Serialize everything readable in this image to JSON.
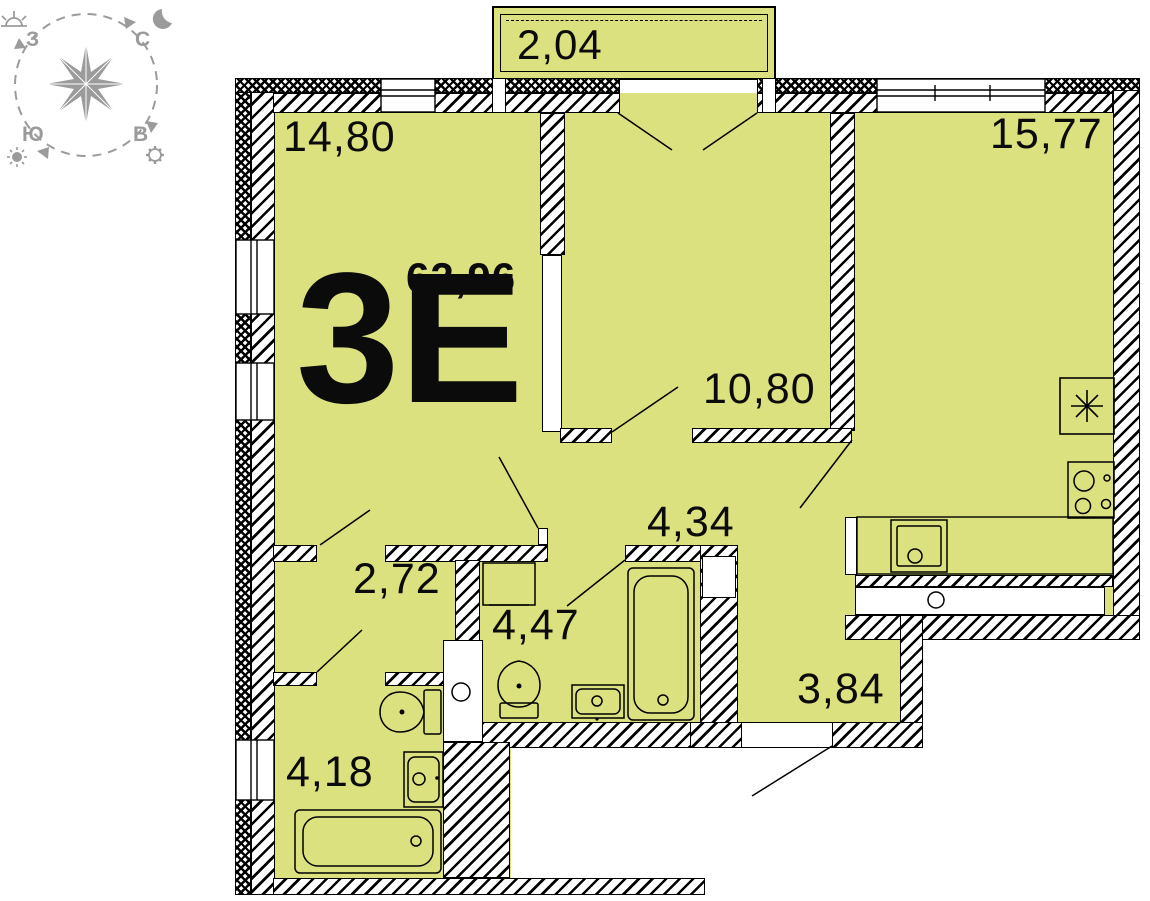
{
  "plan": {
    "type_label": "3Е",
    "total_area": "62,96",
    "rooms": [
      {
        "id": "balcony",
        "area": "2,04"
      },
      {
        "id": "living-room",
        "area": "14,80"
      },
      {
        "id": "kitchen-living",
        "area": "15,77"
      },
      {
        "id": "bedroom",
        "area": "10,80"
      },
      {
        "id": "hall",
        "area": "4,34"
      },
      {
        "id": "corridor",
        "area": "2,72"
      },
      {
        "id": "bathroom",
        "area": "4,47"
      },
      {
        "id": "bathroom-2",
        "area": "4,18"
      },
      {
        "id": "entry",
        "area": "3,84"
      }
    ],
    "compass": {
      "north": "С",
      "east": "В",
      "south": "Ю",
      "west": "З"
    },
    "colors": {
      "room_fill": "#dce17f",
      "line": "#000000",
      "compass_gray": "#9b9b9b"
    }
  }
}
